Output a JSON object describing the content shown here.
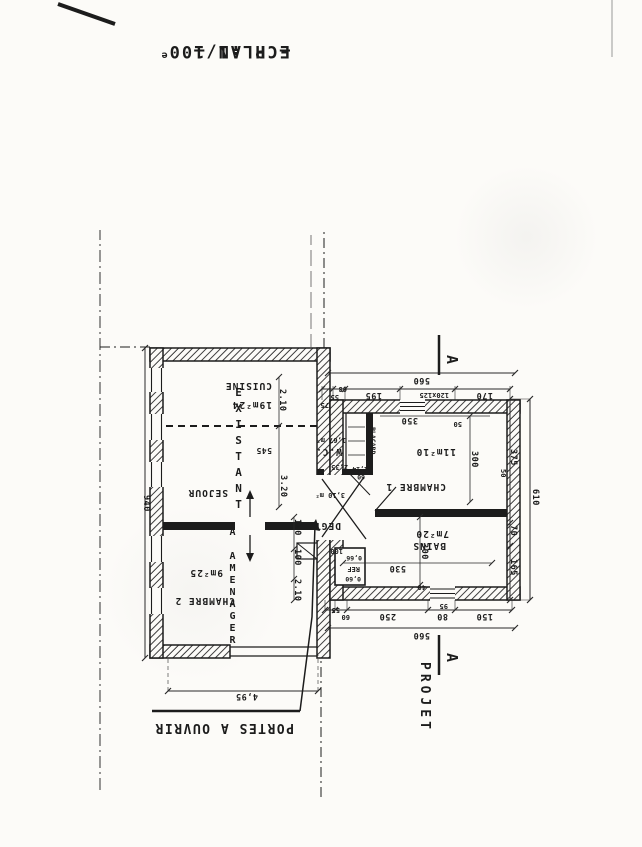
{
  "scan": {
    "paper": "#fcfbf8",
    "ink": "#1c1c1c"
  },
  "title": {
    "plan": "— PLAN —",
    "scale": "ECH :1/100",
    "scale_sup": "e"
  },
  "annotations": {
    "portes": "PORTES A OUVRIR",
    "projet": "PROJET",
    "section_a_top": "A",
    "section_a_bottom": "A"
  },
  "existing": {
    "label": "EXISTANT",
    "sublabel": "A AMENAGER",
    "cuisine_name": "CUISINE",
    "cuisine_area": "19m²24",
    "sejour_name": "SEJOUR",
    "chambre2_name": "CHAMBRE 2",
    "chambre2_area": "9m²25"
  },
  "project": {
    "chambre1_name": "CHAMBRE 1",
    "chambre1_area": "11m²10",
    "bains_name": "BAINS",
    "bains_area": "7m²20",
    "wc_name": "W.C.",
    "wc_area": "1,67 m²",
    "degt_name": "DEGT",
    "degt_area": "3,10 m²",
    "placard": "PLACARD",
    "ref_top": "0,60",
    "ref_name": "REF",
    "ref_bottom": "0,66"
  },
  "dims": {
    "total_top": "560",
    "total_bottom": "560",
    "top_segs": [
      "150",
      "80",
      "250",
      "60",
      "55"
    ],
    "top_95": "95",
    "bottom_segs": [
      "170",
      "120x125",
      "195",
      "68",
      "55"
    ],
    "bottom_75": "75",
    "left_segs": [
      "165",
      "70",
      "375"
    ],
    "left_total": "610",
    "left_95": "95",
    "right_total": "940",
    "opening": "4,95",
    "cuisine_h": "2.10",
    "sejour_h": "3.20",
    "mid": "545",
    "chambre2_h": "2.10",
    "door1": "100",
    "door2": "100",
    "chambre1_w": "350",
    "bains_w": "530",
    "chambre1_h": "300",
    "bains_h": "300",
    "w40": "40",
    "w50a": "50",
    "w50b": "50",
    "ref_100": "100",
    "wc_l": "2,35",
    "plac_w": "1,14",
    "plac_d": "60"
  }
}
